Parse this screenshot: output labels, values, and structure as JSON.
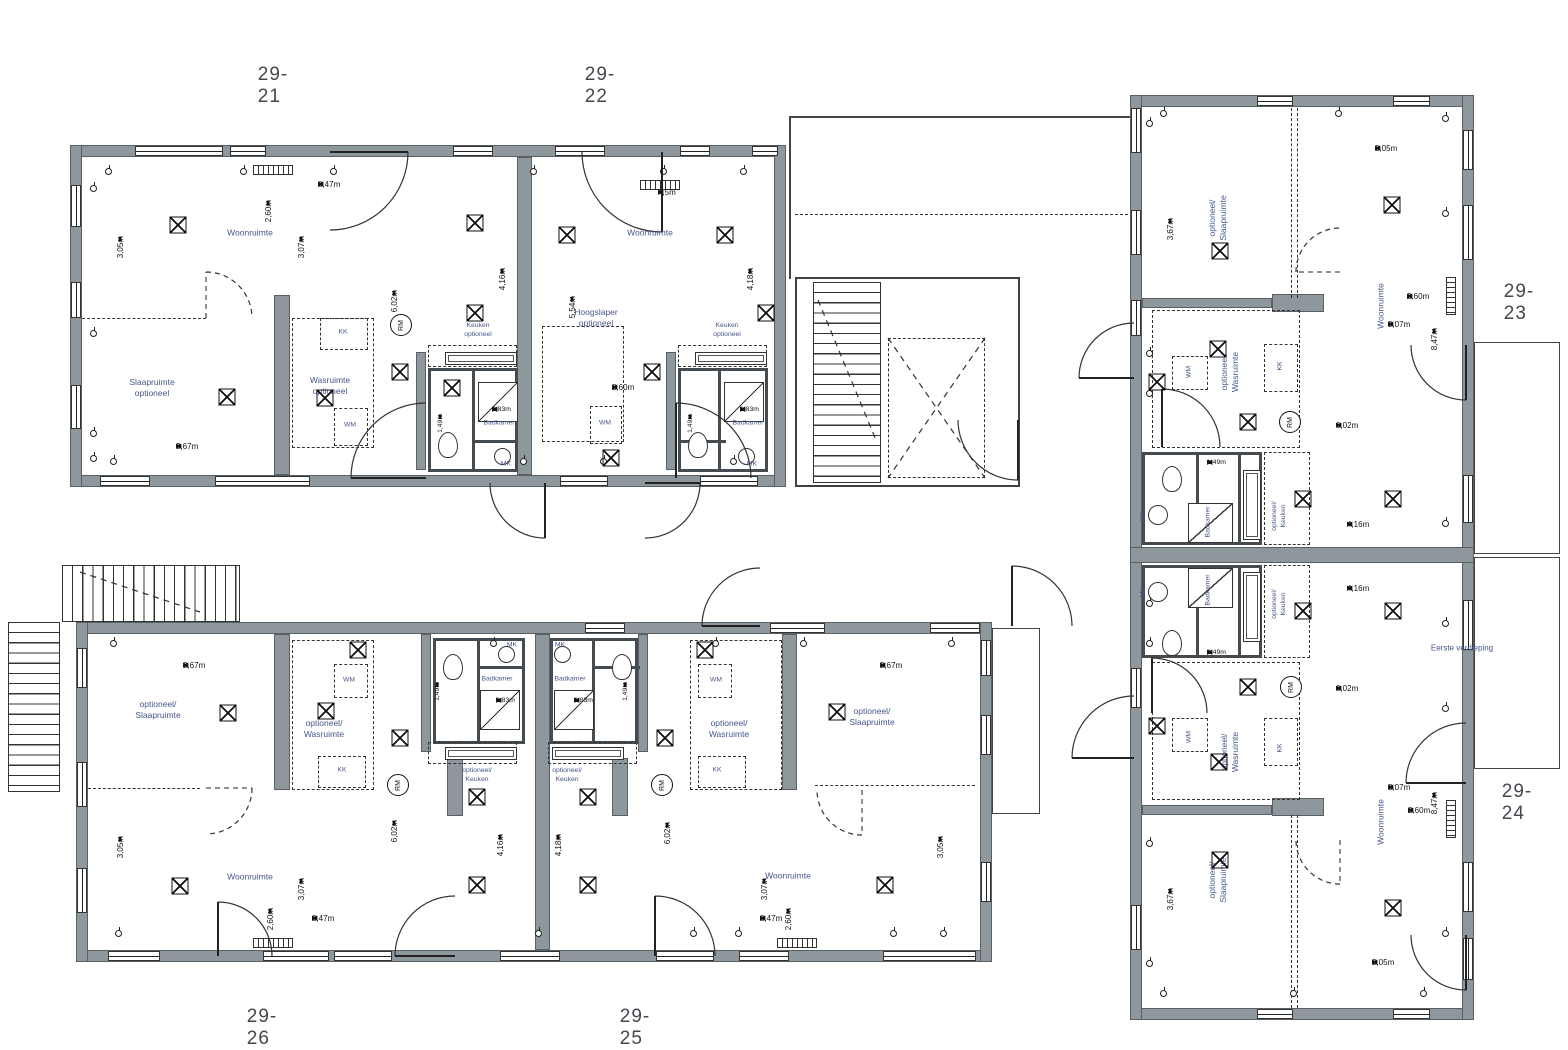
{
  "floor_label": {
    "text": "Eerste verdieping",
    "x": 1462,
    "y": 648
  },
  "smoke_detector_label": "RM",
  "units": [
    {
      "id": "29-21",
      "label_x": 273,
      "label_y": 86,
      "rooms": [
        {
          "t": "Woonruimte",
          "x": 250,
          "y": 233
        },
        {
          "t": "Slaapruimte\noptioneel",
          "x": 152,
          "y": 388
        },
        {
          "t": "Wasruimte\noptioneel",
          "x": 330,
          "y": 386
        },
        {
          "t": "Keuken\noptioneel",
          "x": 478,
          "y": 331,
          "s": 1
        },
        {
          "t": "Badkamer",
          "x": 499,
          "y": 424,
          "s": 1
        },
        {
          "t": "KK",
          "x": 343,
          "y": 333,
          "s": 1
        },
        {
          "t": "WM",
          "x": 350,
          "y": 426,
          "s": 1
        },
        {
          "t": "MK",
          "x": 506,
          "y": 465,
          "s": 1
        }
      ],
      "dims": [
        {
          "t": "8,47m",
          "x": 318,
          "y": 184,
          "o": "h"
        },
        {
          "t": "3,67m",
          "x": 176,
          "y": 446,
          "o": "h"
        },
        {
          "t": "1,83m",
          "x": 492,
          "y": 409,
          "o": "h",
          "s": 1
        },
        {
          "t": "2,60m",
          "x": 268,
          "y": 200,
          "o": "v"
        },
        {
          "t": "3,07m",
          "x": 301,
          "y": 236,
          "o": "v"
        },
        {
          "t": "3,05m",
          "x": 120,
          "y": 236,
          "o": "v"
        },
        {
          "t": "6,02m",
          "x": 394,
          "y": 290,
          "o": "v"
        },
        {
          "t": "4,16m",
          "x": 502,
          "y": 268,
          "o": "v"
        },
        {
          "t": "1,49m",
          "x": 440,
          "y": 414,
          "o": "v",
          "s": 1
        }
      ],
      "smoke": [
        [
          401,
          325
        ]
      ],
      "vents": [
        [
          178,
          225
        ],
        [
          475,
          223
        ],
        [
          475,
          313
        ],
        [
          227,
          397
        ],
        [
          325,
          398
        ],
        [
          400,
          372
        ],
        [
          452,
          388
        ]
      ]
    },
    {
      "id": "29-22",
      "label_x": 600,
      "label_y": 86,
      "rooms": [
        {
          "t": "Woonruimte",
          "x": 650,
          "y": 233
        },
        {
          "t": "Hoogslaper\noptioneel",
          "x": 596,
          "y": 318
        },
        {
          "t": "Keuken\noptioneel",
          "x": 727,
          "y": 331,
          "s": 1
        },
        {
          "t": "Badkamer",
          "x": 748,
          "y": 424,
          "s": 1
        },
        {
          "t": "WM",
          "x": 605,
          "y": 424,
          "s": 1
        },
        {
          "t": "MK",
          "x": 752,
          "y": 465,
          "s": 1
        }
      ],
      "dims": [
        {
          "t": "4,5m",
          "x": 658,
          "y": 192,
          "o": "h"
        },
        {
          "t": "2,60m",
          "x": 612,
          "y": 387,
          "o": "h"
        },
        {
          "t": "1,83m",
          "x": 740,
          "y": 409,
          "o": "h",
          "s": 1
        },
        {
          "t": "5,54m",
          "x": 572,
          "y": 296,
          "o": "v"
        },
        {
          "t": "4,18m",
          "x": 750,
          "y": 268,
          "o": "v"
        },
        {
          "t": "1,49m",
          "x": 690,
          "y": 414,
          "o": "v",
          "s": 1
        }
      ],
      "smoke": [],
      "vents": [
        [
          567,
          235
        ],
        [
          725,
          235
        ],
        [
          766,
          313
        ],
        [
          652,
          372
        ],
        [
          611,
          458
        ]
      ]
    },
    {
      "id": "29-23",
      "label_x": 1519,
      "label_y": 303,
      "rooms": [
        {
          "t": "optioneel/\nSlaapruimte",
          "x": 1218,
          "y": 218,
          "r": 1
        },
        {
          "t": "Woonruimte",
          "x": 1381,
          "y": 306,
          "r": 1
        },
        {
          "t": "optioneel/\nWasruimte",
          "x": 1230,
          "y": 372,
          "r": 1
        },
        {
          "t": "optioneel/\nKeuken",
          "x": 1280,
          "y": 516,
          "r": 1,
          "s": 1
        },
        {
          "t": "Badkamer",
          "x": 1209,
          "y": 522,
          "r": 1,
          "s": 1
        },
        {
          "t": "WM",
          "x": 1190,
          "y": 372,
          "r": 1,
          "s": 1
        },
        {
          "t": "KK",
          "x": 1281,
          "y": 366,
          "r": 1,
          "s": 1
        },
        {
          "t": "MK",
          "x": 1144,
          "y": 516,
          "r": 1,
          "s": 1
        }
      ],
      "dims": [
        {
          "t": "3,05m",
          "x": 1375,
          "y": 148,
          "o": "h"
        },
        {
          "t": "2,60m",
          "x": 1407,
          "y": 296,
          "o": "h"
        },
        {
          "t": "3,07m",
          "x": 1388,
          "y": 324,
          "o": "h"
        },
        {
          "t": "6,02m",
          "x": 1336,
          "y": 425,
          "o": "h"
        },
        {
          "t": "4,16m",
          "x": 1347,
          "y": 524,
          "o": "h"
        },
        {
          "t": "1,49m",
          "x": 1207,
          "y": 462,
          "o": "h",
          "s": 1
        },
        {
          "t": "3,67m",
          "x": 1170,
          "y": 218,
          "o": "v"
        },
        {
          "t": "8,47m",
          "x": 1434,
          "y": 328,
          "o": "v"
        }
      ],
      "smoke": [
        [
          1290,
          422
        ]
      ],
      "vents": [
        [
          1392,
          205
        ],
        [
          1220,
          251
        ],
        [
          1218,
          349
        ],
        [
          1157,
          382
        ],
        [
          1248,
          422
        ],
        [
          1303,
          499
        ],
        [
          1393,
          499
        ]
      ]
    },
    {
      "id": "29-24",
      "label_x": 1517,
      "label_y": 803,
      "rooms": [
        {
          "t": "optioneel/\nKeuken",
          "x": 1280,
          "y": 604,
          "r": 1,
          "s": 1
        },
        {
          "t": "Badkamer",
          "x": 1209,
          "y": 590,
          "r": 1,
          "s": 1
        },
        {
          "t": "optioneel/\nWasruimte",
          "x": 1230,
          "y": 752,
          "r": 1
        },
        {
          "t": "optioneel/\nSlaapruimte",
          "x": 1218,
          "y": 880,
          "r": 1
        },
        {
          "t": "Woonruimte",
          "x": 1381,
          "y": 822,
          "r": 1
        },
        {
          "t": "WM",
          "x": 1190,
          "y": 737,
          "r": 1,
          "s": 1
        },
        {
          "t": "KK",
          "x": 1281,
          "y": 748,
          "r": 1,
          "s": 1
        },
        {
          "t": "MK",
          "x": 1144,
          "y": 592,
          "r": 1,
          "s": 1
        }
      ],
      "dims": [
        {
          "t": "4,16m",
          "x": 1347,
          "y": 588,
          "o": "h"
        },
        {
          "t": "6,02m",
          "x": 1336,
          "y": 688,
          "o": "h"
        },
        {
          "t": "1,49m",
          "x": 1207,
          "y": 652,
          "o": "h",
          "s": 1
        },
        {
          "t": "3,07m",
          "x": 1388,
          "y": 787,
          "o": "h"
        },
        {
          "t": "2,60m",
          "x": 1408,
          "y": 810,
          "o": "h"
        },
        {
          "t": "3,05m",
          "x": 1372,
          "y": 962,
          "o": "h"
        },
        {
          "t": "8,47m",
          "x": 1434,
          "y": 792,
          "o": "v"
        },
        {
          "t": "3,67m",
          "x": 1170,
          "y": 888,
          "o": "v"
        }
      ],
      "smoke": [
        [
          1291,
          687
        ]
      ],
      "vents": [
        [
          1303,
          611
        ],
        [
          1393,
          611
        ],
        [
          1248,
          687
        ],
        [
          1157,
          726
        ],
        [
          1219,
          762
        ],
        [
          1220,
          860
        ],
        [
          1393,
          908
        ]
      ]
    },
    {
      "id": "29-25",
      "label_x": 635,
      "label_y": 1028,
      "rooms": [
        {
          "t": "optioneel/\nSlaapruimte",
          "x": 872,
          "y": 717
        },
        {
          "t": "optioneel/\nWasruimte",
          "x": 729,
          "y": 729
        },
        {
          "t": "Woonruimte",
          "x": 788,
          "y": 876
        },
        {
          "t": "optioneel/\nKeuken",
          "x": 567,
          "y": 776,
          "s": 1
        },
        {
          "t": "Badkamer",
          "x": 570,
          "y": 680,
          "s": 1
        },
        {
          "t": "KK",
          "x": 717,
          "y": 771,
          "s": 1
        },
        {
          "t": "WM",
          "x": 716,
          "y": 681,
          "s": 1
        },
        {
          "t": "MK",
          "x": 560,
          "y": 646,
          "s": 1
        }
      ],
      "dims": [
        {
          "t": "3,67m",
          "x": 880,
          "y": 665,
          "o": "h"
        },
        {
          "t": "8,47m",
          "x": 760,
          "y": 918,
          "o": "h"
        },
        {
          "t": "1,83m",
          "x": 574,
          "y": 700,
          "o": "h",
          "s": 1
        },
        {
          "t": "3,05m",
          "x": 940,
          "y": 836,
          "o": "v"
        },
        {
          "t": "2,60m",
          "x": 788,
          "y": 908,
          "o": "v"
        },
        {
          "t": "3,07m",
          "x": 764,
          "y": 878,
          "o": "v"
        },
        {
          "t": "6,02m",
          "x": 667,
          "y": 822,
          "o": "v"
        },
        {
          "t": "4,18m",
          "x": 558,
          "y": 834,
          "o": "v"
        },
        {
          "t": "1,49m",
          "x": 625,
          "y": 682,
          "o": "v",
          "s": 1
        }
      ],
      "smoke": [
        [
          662,
          785
        ]
      ],
      "vents": [
        [
          705,
          650
        ],
        [
          837,
          712
        ],
        [
          665,
          738
        ],
        [
          588,
          797
        ],
        [
          588,
          885
        ],
        [
          885,
          885
        ]
      ]
    },
    {
      "id": "29-26",
      "label_x": 262,
      "label_y": 1028,
      "rooms": [
        {
          "t": "optioneel/\nSlaapruimte",
          "x": 158,
          "y": 710
        },
        {
          "t": "optioneel/\nWasruimte",
          "x": 324,
          "y": 729
        },
        {
          "t": "Woonruimte",
          "x": 250,
          "y": 877
        },
        {
          "t": "optioneel/\nKeuken",
          "x": 477,
          "y": 776,
          "s": 1
        },
        {
          "t": "Badkamer",
          "x": 497,
          "y": 680,
          "s": 1
        },
        {
          "t": "KK",
          "x": 342,
          "y": 771,
          "s": 1
        },
        {
          "t": "WM",
          "x": 349,
          "y": 681,
          "s": 1
        },
        {
          "t": "MK",
          "x": 512,
          "y": 646,
          "s": 1
        }
      ],
      "dims": [
        {
          "t": "3,67m",
          "x": 183,
          "y": 665,
          "o": "h"
        },
        {
          "t": "8,47m",
          "x": 312,
          "y": 918,
          "o": "h"
        },
        {
          "t": "1,83m",
          "x": 496,
          "y": 700,
          "o": "h",
          "s": 1
        },
        {
          "t": "3,05m",
          "x": 120,
          "y": 836,
          "o": "v"
        },
        {
          "t": "2,60m",
          "x": 270,
          "y": 908,
          "o": "v"
        },
        {
          "t": "3,07m",
          "x": 301,
          "y": 878,
          "o": "v"
        },
        {
          "t": "6,02m",
          "x": 394,
          "y": 820,
          "o": "v"
        },
        {
          "t": "4,16m",
          "x": 500,
          "y": 834,
          "o": "v"
        },
        {
          "t": "1,49m",
          "x": 437,
          "y": 682,
          "o": "v",
          "s": 1
        }
      ],
      "smoke": [
        [
          398,
          785
        ]
      ],
      "vents": [
        [
          358,
          650
        ],
        [
          228,
          713
        ],
        [
          326,
          711
        ],
        [
          400,
          738
        ],
        [
          477,
          797
        ],
        [
          180,
          886
        ],
        [
          477,
          885
        ]
      ]
    }
  ]
}
